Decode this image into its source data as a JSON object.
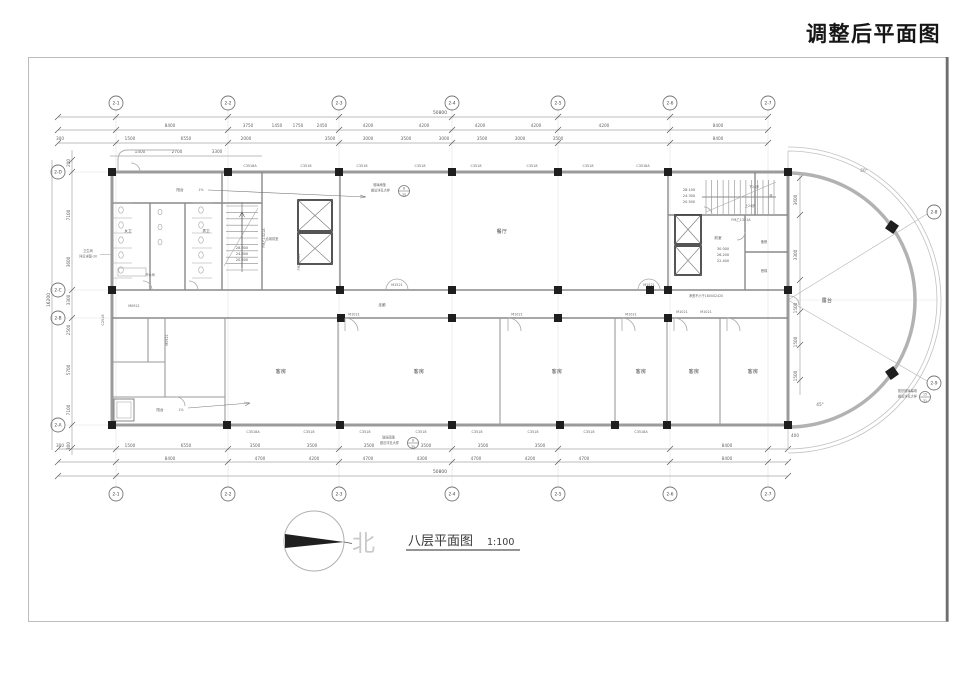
{
  "title": "调整后平面图",
  "caption": {
    "label": "八层平面图",
    "scale": "1:100",
    "north": "北"
  },
  "grid_bubbles": {
    "top": [
      "2-1",
      "2-2",
      "2-3",
      "2-4",
      "2-5",
      "2-6",
      "2-7"
    ],
    "bottom": [
      "2-1",
      "2-2",
      "2-3",
      "2-4",
      "2-5",
      "2-6",
      "2-7"
    ],
    "left": [
      "2-D",
      "2-C",
      "2-B",
      "2-A"
    ],
    "diag": [
      "2-8",
      "2-9"
    ]
  },
  "dimensions": {
    "top_total": "50800",
    "top_a": [
      "8400",
      "3750",
      "1450",
      "1750",
      "2450",
      "4200",
      "4200",
      "4200",
      "4200",
      "4200",
      "8400"
    ],
    "top_b": [
      "300",
      "1500",
      "6550",
      "2000",
      "3500",
      "3000",
      "3500",
      "3000",
      "3500",
      "3000",
      "3500",
      "8400"
    ],
    "top_c": [
      "1400",
      "2700",
      "3300"
    ],
    "bottom_a": [
      "300",
      "1500",
      "6550",
      "3500",
      "3500",
      "3500",
      "3500",
      "3500",
      "3500",
      "8400"
    ],
    "bottom_b": [
      "8400",
      "4700",
      "4200",
      "4700",
      "4300",
      "4700",
      "4200",
      "4700",
      "8400"
    ],
    "bottom_total": "50800",
    "left_chain": [
      "200",
      "7100",
      "3600",
      "3300",
      "2500",
      "5700",
      "7100",
      "300"
    ],
    "left_total": "16200",
    "right_chain": [
      "3600",
      "3300",
      "1500",
      "1500",
      "1500"
    ],
    "arc": [
      "400",
      "60°",
      "45°"
    ]
  },
  "window_tags": {
    "top": [
      "C3518A",
      "C3518",
      "C3518",
      "C3518",
      "C3518",
      "C3518",
      "C3518",
      "C3518A"
    ],
    "bottom": [
      "C3518A",
      "C3518",
      "C3518",
      "C3518",
      "C3518",
      "C3518",
      "C3518",
      "C3518A"
    ],
    "left": "C2518"
  },
  "door_tags": {
    "m1521": "M1521",
    "m1021": "M1021",
    "m0921": "M0921",
    "fm_a": "FM乙1321A",
    "fm_b": "FM乙1021"
  },
  "room_labels": {
    "hall": "餐厅",
    "guest": "客房",
    "corridor": "走廊",
    "balcony": "阳台",
    "terrace": "露台",
    "ante": "前室",
    "shared_ante": "合用前室",
    "pantry": "备餐",
    "dumbwaiter": "餐梯",
    "duct": "风",
    "hot_water": "开水间",
    "wc_f": "女卫",
    "wc_m": "男卫",
    "slope": "1%"
  },
  "stair_notes": {
    "up": "上24步",
    "down": "下24步"
  },
  "levels": {
    "stair_left": [
      "28.300",
      "24.800",
      "20.500"
    ],
    "stair_right": [
      "28.100",
      "24.300",
      "20.500"
    ],
    "elev_right": [
      "30.000",
      "26.200",
      "22.400"
    ]
  },
  "callouts": {
    "canopy_1": "玻璃雨篷",
    "canopy_2": "做法详见大样",
    "canopy_num": "8",
    "canopy_den": "35",
    "arc_1": "弧形玻璃幕墙",
    "arc_2": "做法详见大样",
    "arc_num": "15",
    "arc_den": "31",
    "toilet_1": "卫生间",
    "toilet_2": "详见详图-30",
    "door_note": "净宽不小于1800X2420"
  },
  "colors": {
    "line_dark": "#1e1e1e",
    "wall_gray": "#9b9b9b",
    "dim_gray": "#8a8a8a",
    "light_gray": "#c9c9c9"
  }
}
